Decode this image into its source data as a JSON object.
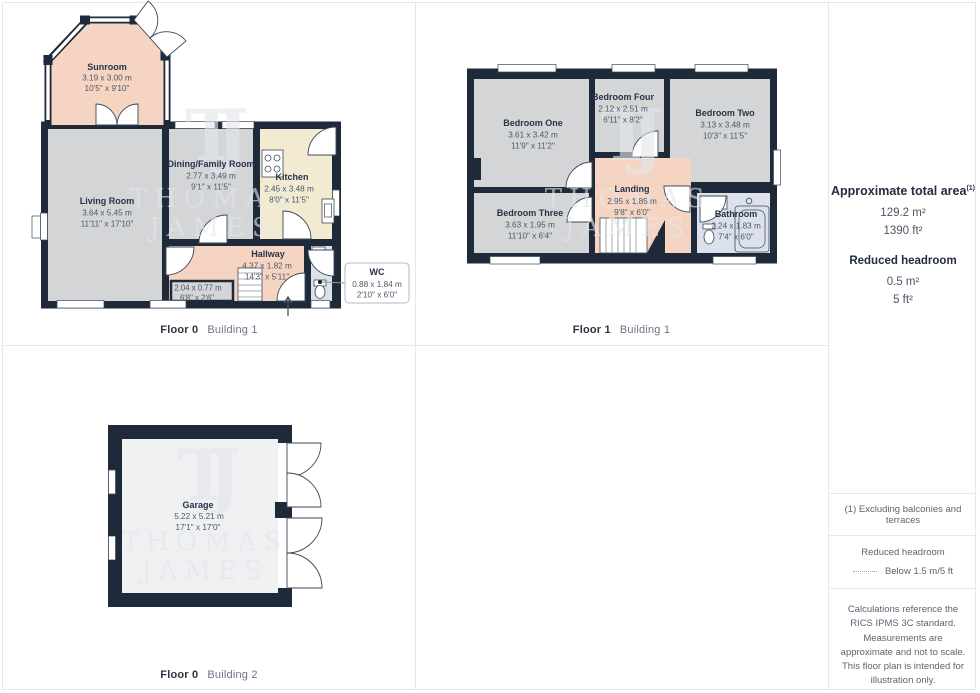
{
  "watermark": {
    "monogram": "TJ",
    "line1": "THOMAS",
    "line2": "JAMES"
  },
  "plans": {
    "floor0b1": {
      "caption_floor": "Floor 0",
      "caption_building": "Building 1",
      "rooms": {
        "sunroom": {
          "name": "Sunroom",
          "metric": "3.19 x 3.00 m",
          "imperial": "10'5\" x 9'10\""
        },
        "living": {
          "name": "Living Room",
          "metric": "3.64 x 5.45 m",
          "imperial": "11'11\" x 17'10\""
        },
        "dining": {
          "name": "Dining/Family Room",
          "metric": "2.77 x 3.49 m",
          "imperial": "9'1\" x 11'5\""
        },
        "kitchen": {
          "name": "Kitchen",
          "metric": "2.45 x 3.48 m",
          "imperial": "8'0\" x 11'5\""
        },
        "hallway": {
          "name": "Hallway",
          "metric": "4.37 x 1.82 m",
          "imperial": "14'3\" x 5'11\""
        },
        "store": {
          "metric": "2.04 x 0.77 m",
          "imperial": "6'8\" x 2'6\""
        },
        "wc": {
          "name": "WC",
          "metric": "0.88 x 1.84 m",
          "imperial": "2'10\" x 6'0\""
        }
      }
    },
    "floor1b1": {
      "caption_floor": "Floor 1",
      "caption_building": "Building 1",
      "rooms": {
        "bedroom_one": {
          "name": "Bedroom One",
          "metric": "3.61 x 3.42 m",
          "imperial": "11'9\" x 11'2\""
        },
        "bedroom_four": {
          "name": "Bedroom Four",
          "metric": "2.12 x 2.51 m",
          "imperial": "6'11\" x 8'2\""
        },
        "bedroom_two": {
          "name": "Bedroom Two",
          "metric": "3.13 x 3.48 m",
          "imperial": "10'3\" x 11'5\""
        },
        "bedroom_three": {
          "name": "Bedroom Three",
          "metric": "3.63 x 1.95 m",
          "imperial": "11'10\" x 6'4\""
        },
        "landing": {
          "name": "Landing",
          "metric": "2.95 x 1.85 m",
          "imperial": "9'8\" x 6'0\""
        },
        "bathroom": {
          "name": "Bathroom",
          "metric": "2.24 x 1.83 m",
          "imperial": "7'4\" x 6'0\""
        }
      }
    },
    "floor0b2": {
      "caption_floor": "Floor 0",
      "caption_building": "Building 2",
      "rooms": {
        "garage": {
          "name": "Garage",
          "metric": "5.22 x 5.21 m",
          "imperial": "17'1\" x 17'0\""
        }
      }
    }
  },
  "sidebar": {
    "area_title": "Approximate total area",
    "area_title_sup": "(1)",
    "area_m2": "129.2 m²",
    "area_ft2": "1390 ft²",
    "reduced_title": "Reduced headroom",
    "reduced_m2": "0.5 m²",
    "reduced_ft2": "5 ft²",
    "note1": "(1) Excluding balconies and terraces",
    "legend_title": "Reduced headroom",
    "legend_value": "Below 1.5 m/5 ft",
    "disclaimer": "Calculations reference the RICS IPMS 3C standard. Measurements are approximate and not to scale. This floor plan is intended for illustration only.",
    "brand_name": "GIRAFFE",
    "brand_suffix": "360"
  },
  "colors": {
    "wall": "#1e2a39",
    "floor_gray": "#d3d5d7",
    "floor_peach": "#f5d5c2",
    "floor_cream": "#f2ead1",
    "floor_blue": "#dce1eb",
    "floor_garage": "#eef0f2",
    "divider": "#e6e8ea",
    "text_dark": "#27334a",
    "text_dim": "#4d5866"
  }
}
